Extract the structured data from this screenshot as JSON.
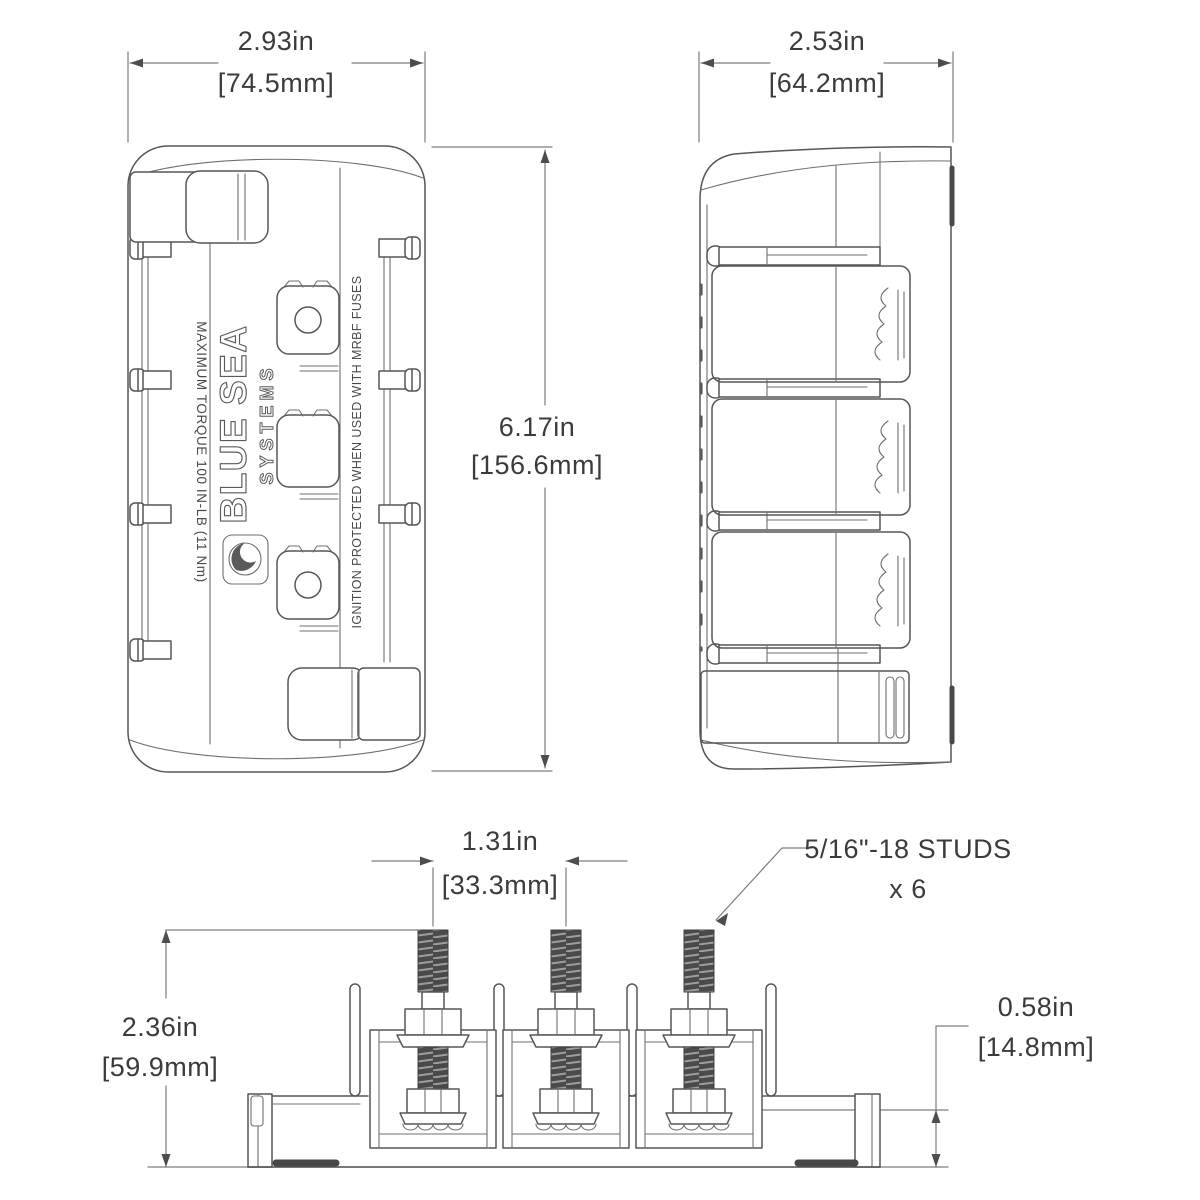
{
  "front_view": {
    "width_in": "2.93in",
    "width_mm": "[74.5mm]",
    "height_in": "6.17in",
    "height_mm": "[156.6mm]",
    "torque_label": "MAXIMUM TORQUE 100 IN-LB (11 Nm)",
    "ignition_label": "IGNITION PROTECTED WHEN USED WITH MRBF FUSES",
    "logo_line1": "BLUE SEA",
    "logo_line2": "SYSTEMS"
  },
  "side_view": {
    "width_in": "2.53in",
    "width_mm": "[64.2mm]"
  },
  "stud_view": {
    "stud_spacing_in": "1.31in",
    "stud_spacing_mm": "[33.3mm]",
    "overall_height_in": "2.36in",
    "overall_height_mm": "[59.9mm]",
    "base_height_in": "0.58in",
    "base_height_mm": "[14.8mm]",
    "stud_callout_line1": "5/16\"-18 STUDS",
    "stud_callout_line2": "x 6"
  },
  "colors": {
    "line": "#575757",
    "dim_line": "#7d7d7d",
    "text": "#3b3b3b",
    "thread_fill": "#4a4a4a",
    "background": "#ffffff"
  }
}
